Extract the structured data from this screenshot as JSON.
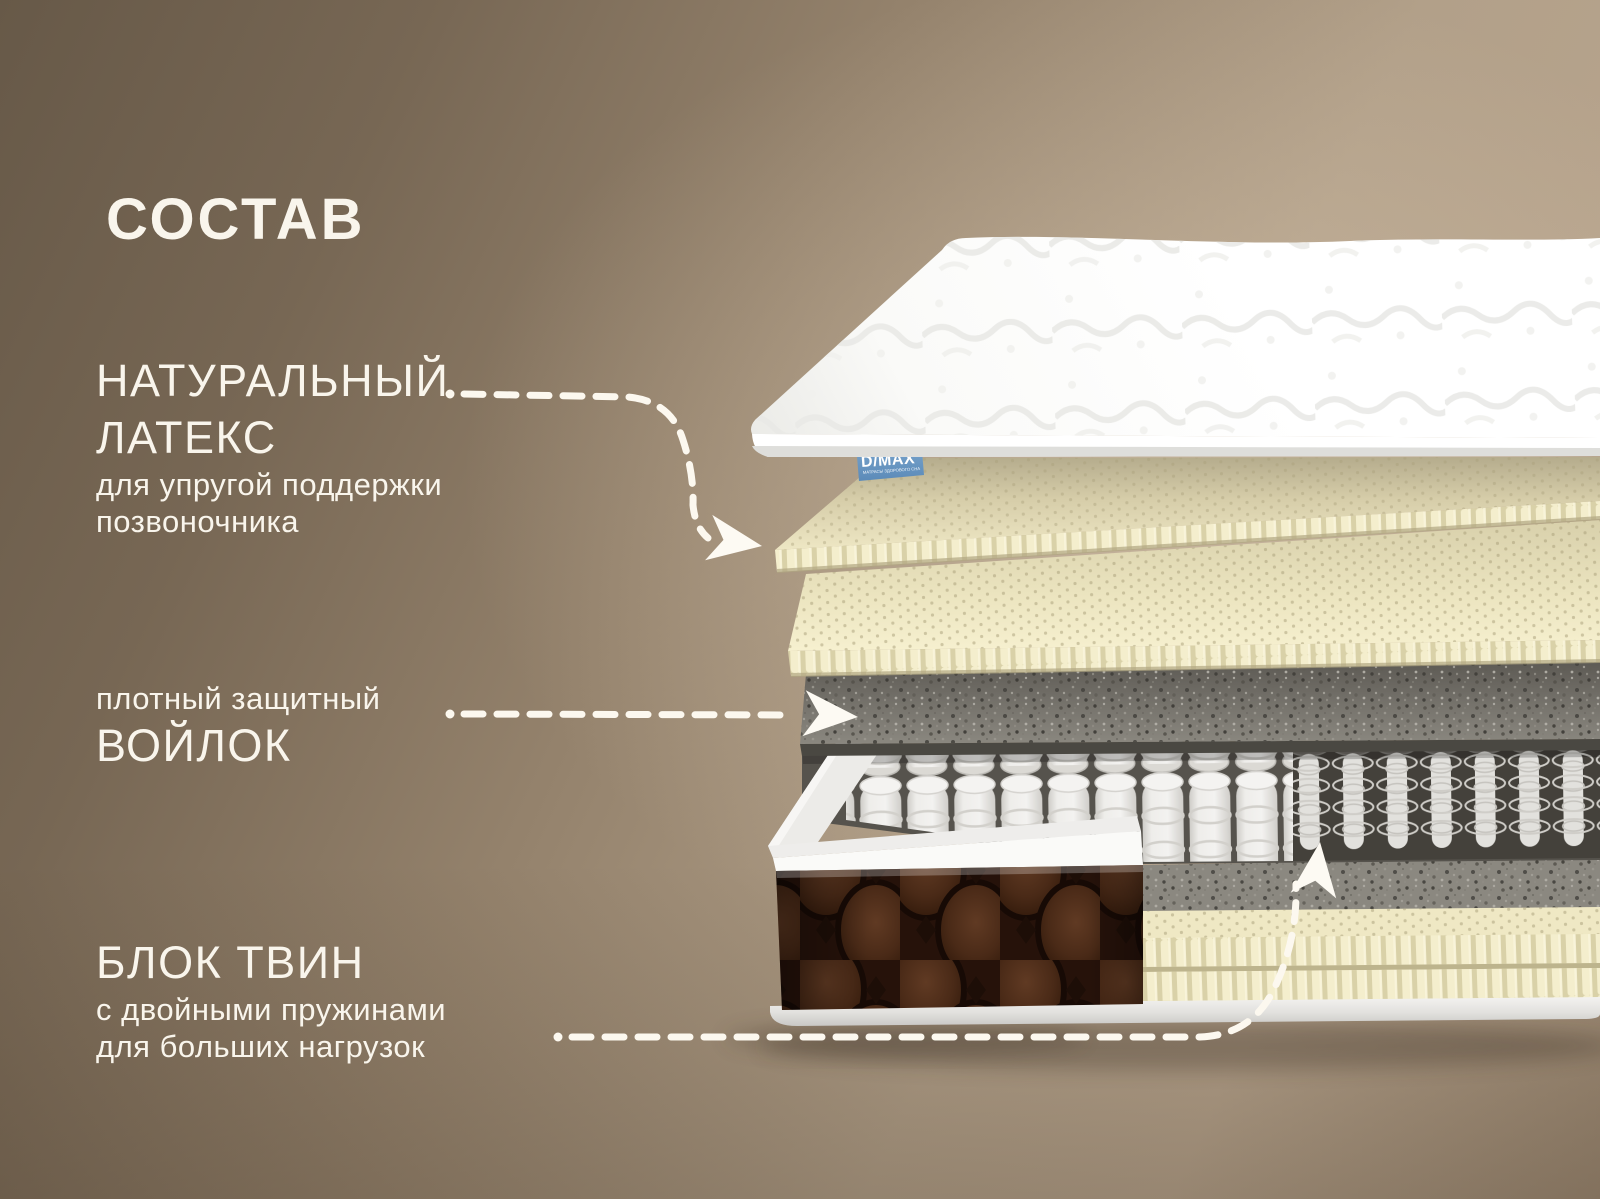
{
  "title": "СОСТАВ",
  "labels": {
    "latex": {
      "line1": "НАТУРАЛЬНЫЙ",
      "line2": "ЛАТЕКС",
      "desc1": "для упругой поддержки",
      "desc2": "позвоночника"
    },
    "felt": {
      "small": "плотный защитный",
      "big": "ВОЙЛОК"
    },
    "twin": {
      "big": "БЛОК ТВИН",
      "desc1": "с двойными пружинами",
      "desc2": "для больших нагрузок"
    }
  },
  "brand": {
    "name": "D/MAX",
    "tagline": "МАТРАСЫ ЗДОРОВОГО СНА"
  },
  "diagram": {
    "layers": [
      "quilted-top-cover",
      "natural-latex-layer-1",
      "natural-latex-layer-2",
      "protective-felt-layer",
      "twin-pocket-spring-block",
      "double-spring-cutaway",
      "foam-frame",
      "brown-knit-side-panel",
      "bottom-felt-layer",
      "bottom-latex-layer",
      "base-edge"
    ]
  },
  "colors": {
    "background_dark": "#675948",
    "background_light": "#b6a38c",
    "text": "#f9f5ec",
    "connector": "#fcf8ef",
    "brand_blue": "#6897c4",
    "latex_cream": "#f0e9c6",
    "felt_gray": "#6f6c66",
    "knit_brown": "#361e10",
    "quilt_white": "#ffffff"
  }
}
